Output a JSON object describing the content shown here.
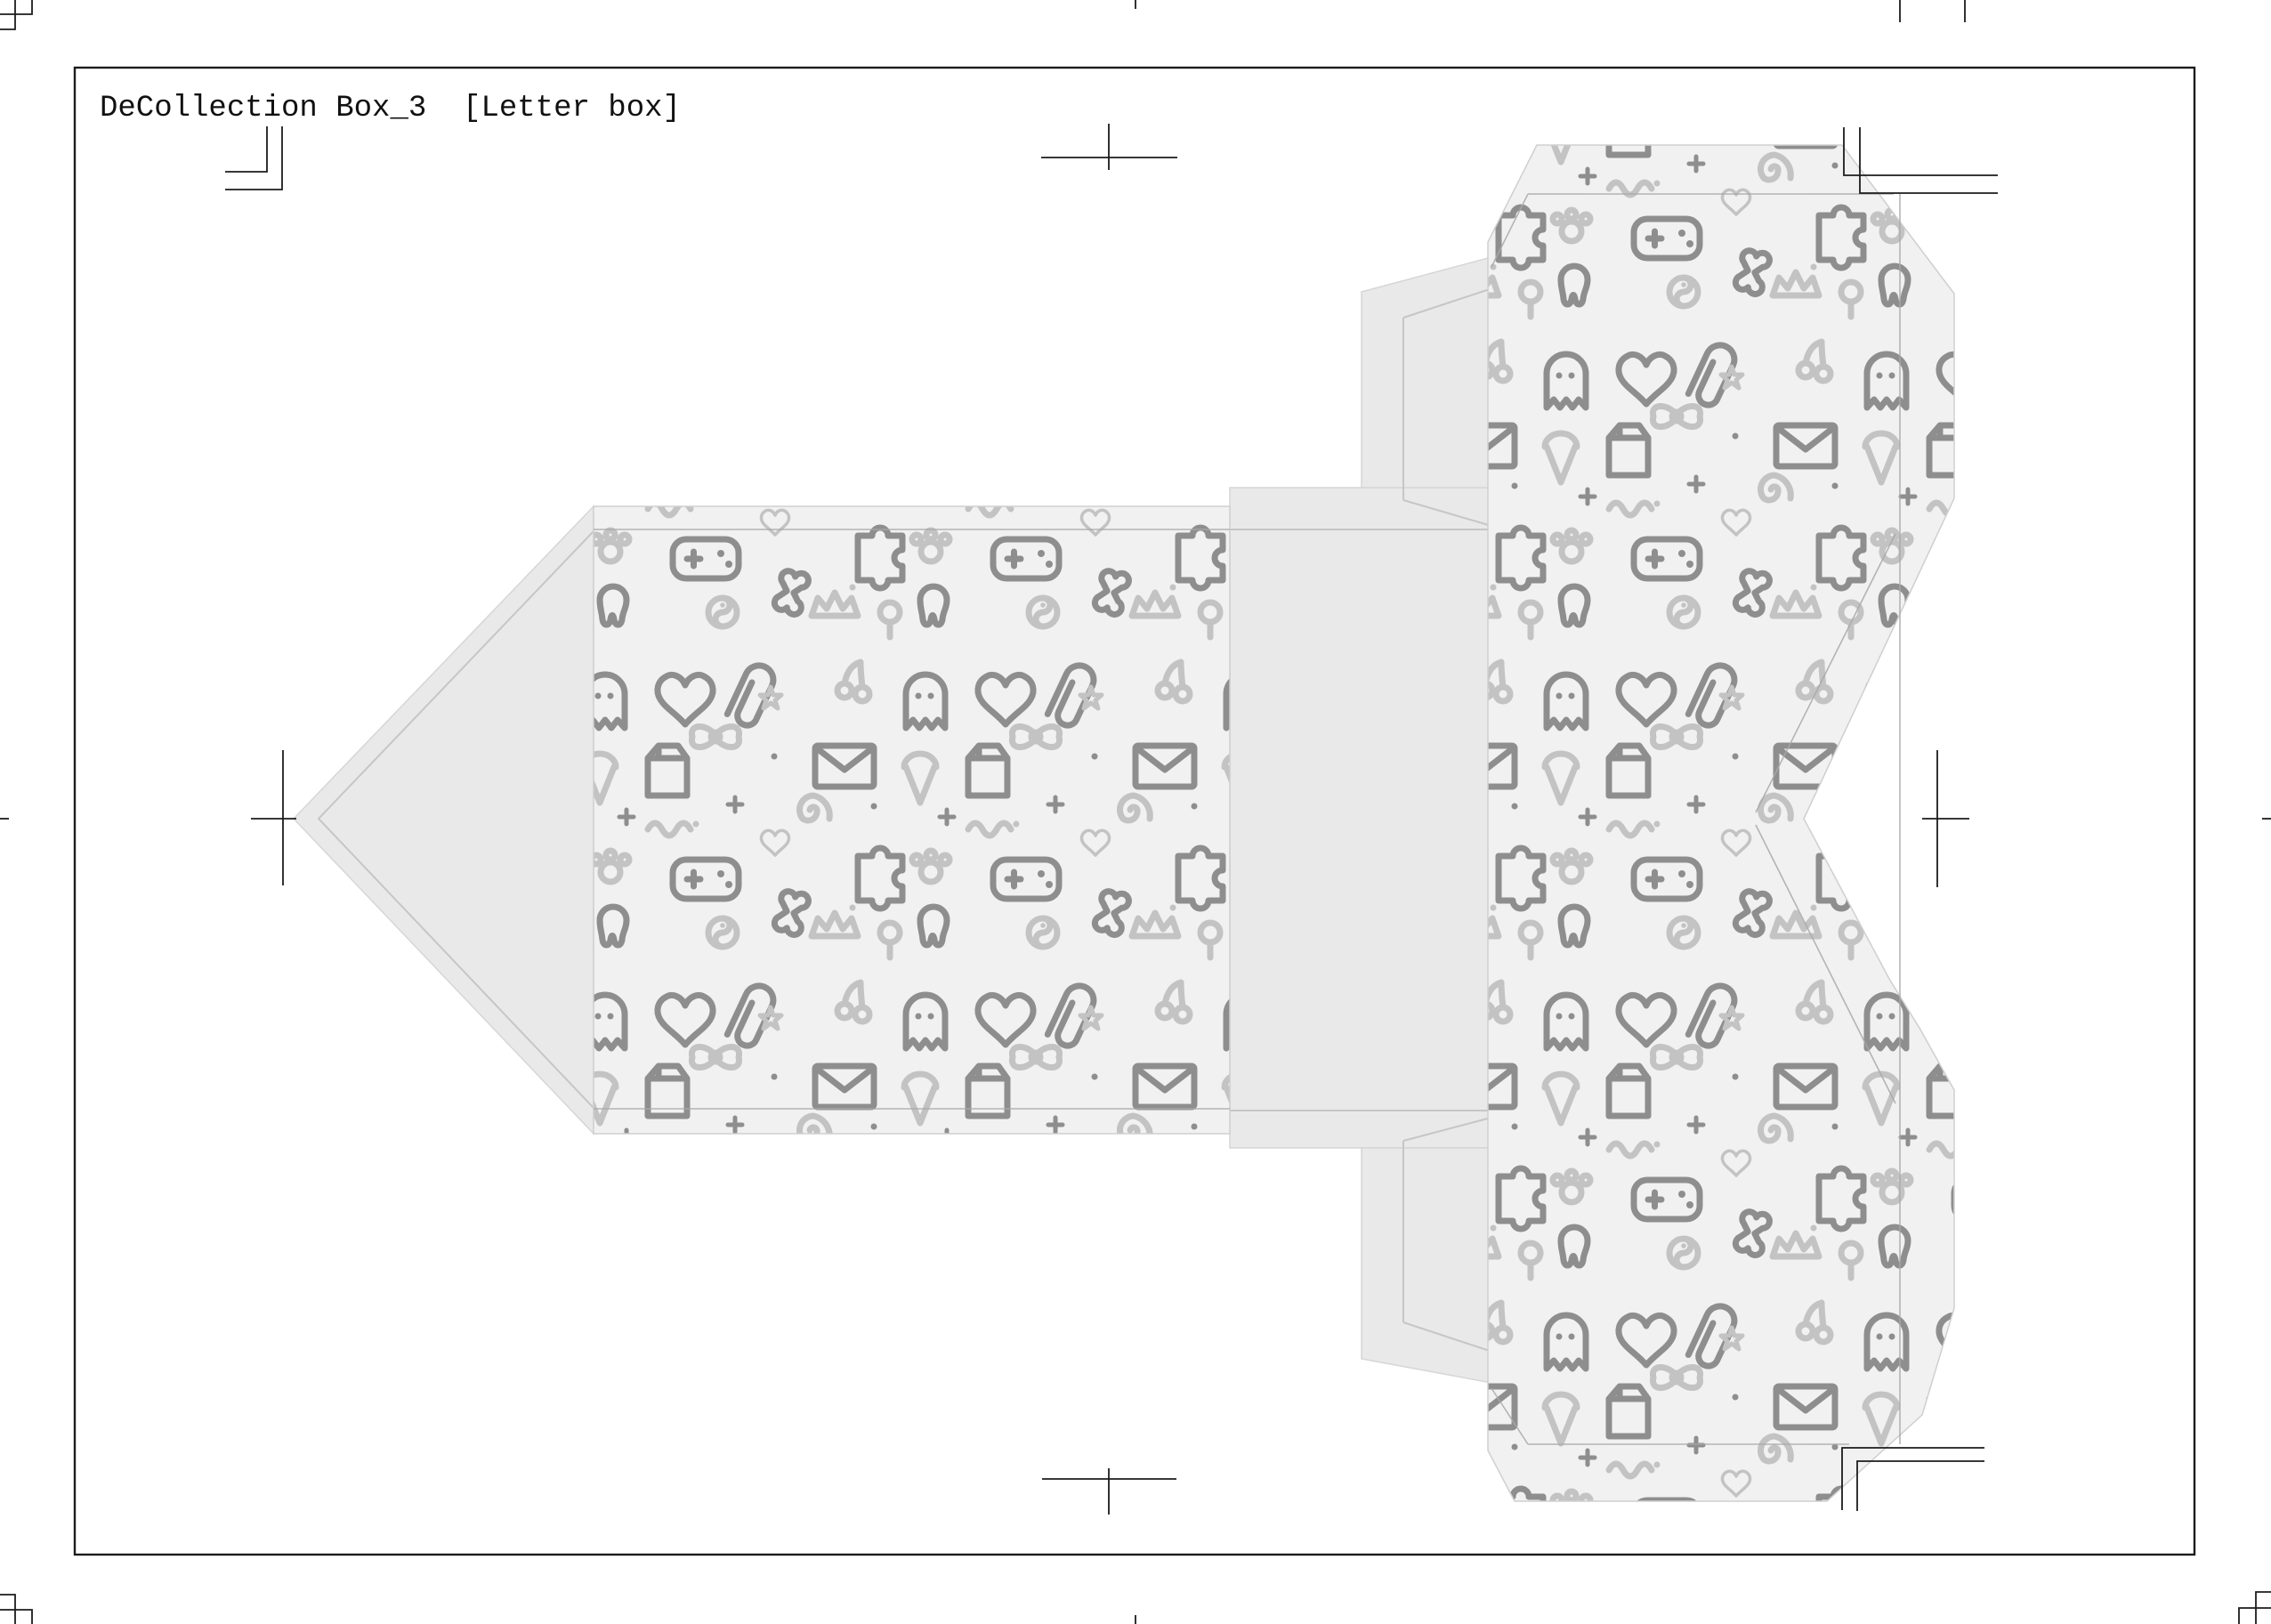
{
  "document": {
    "title": "DeCollection Box_3  [Letter box]"
  },
  "colors": {
    "page_background": "#ffffff",
    "border": "#1c1c1c",
    "crop_mark": "#1c1c1c",
    "pattern_background": "#f1f1f1",
    "doodle_dark": "#8e8e8e",
    "doodle_light": "#c3c3c3",
    "flap_fill": "#e9e9e9",
    "flap_edge": "#d6d6d6",
    "flap_crease": "#c6c6c6",
    "fold_line": "#a9a9a9",
    "panel_edge": "#cfcfcf"
  },
  "pattern_motifs": [
    "heart",
    "paperclip",
    "envelope",
    "ghost",
    "game-controller",
    "bone",
    "puzzle-piece",
    "tooth",
    "milk-carton",
    "plus-sparkle",
    "spiral",
    "ribbon-bow",
    "ice-cream-cone",
    "star",
    "cherry",
    "yin-yang",
    "paw-print",
    "lollipop",
    "crown",
    "wavy-scribble",
    "sprinkle-dot"
  ]
}
